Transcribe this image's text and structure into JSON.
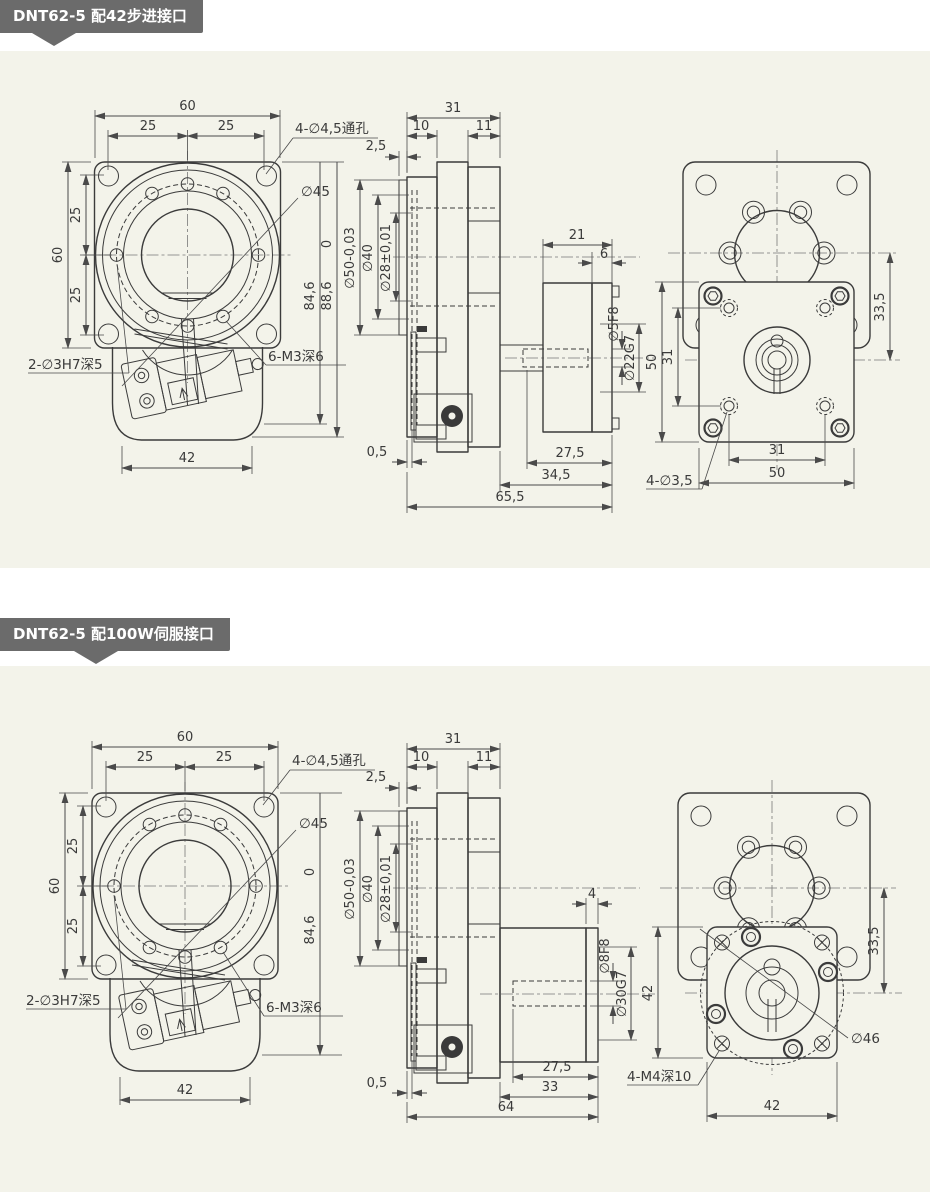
{
  "colors": {
    "panel_bg": "#f3f3ea",
    "header_bg": "#6b6b6b",
    "header_text": "#ffffff",
    "line": "#3b3b3b"
  },
  "s1": {
    "title": "DNT62-5 配42步进接口",
    "front": {
      "w60": "60",
      "w25l": "25",
      "w25r": "25",
      "h60": "60",
      "h25u": "25",
      "h25d": "25",
      "holes": "4-∅4,5通孔",
      "race": "∅45",
      "ord0": "0",
      "h846": "84,6",
      "h886": "88,6",
      "pins": "2-∅3H7深5",
      "screws": "6-M3深6",
      "w42": "42"
    },
    "side": {
      "w31": "31",
      "w10": "10",
      "w11": "11",
      "lip25": "2,5",
      "d50": "∅50-0,03",
      "d40": "∅40",
      "d28": "∅28±0,01",
      "l21": "21",
      "l6": "6",
      "d5": "∅5F8",
      "d22": "∅22G7",
      "l05": "0,5",
      "l275": "27,5",
      "l345": "34,5",
      "l655": "65,5"
    },
    "rear": {
      "off335": "33,5",
      "v50": "50",
      "v31": "31",
      "b31": "31",
      "b50": "50",
      "holes": "4-∅3,5"
    }
  },
  "s2": {
    "title": "DNT62-5 配100W伺服接口",
    "front": {
      "w60": "60",
      "w25l": "25",
      "w25r": "25",
      "h60": "60",
      "h25u": "25",
      "h25d": "25",
      "holes": "4-∅4,5通孔",
      "race": "∅45",
      "ord0": "0",
      "h846": "84,6",
      "pins": "2-∅3H7深5",
      "screws": "6-M3深6",
      "w42": "42"
    },
    "side": {
      "w31": "31",
      "w10": "10",
      "w11": "11",
      "lip25": "2,5",
      "d50": "∅50-0,03",
      "d40": "∅40",
      "d28": "∅28±0,01",
      "step4": "4",
      "d8": "∅8F8",
      "d30": "∅30G7",
      "l05": "0,5",
      "l275": "27,5",
      "l33": "33",
      "l64": "64"
    },
    "rear": {
      "off335": "33,5",
      "v42": "42",
      "b42": "42",
      "screws": "4-M4深10",
      "bc46": "∅46"
    }
  }
}
